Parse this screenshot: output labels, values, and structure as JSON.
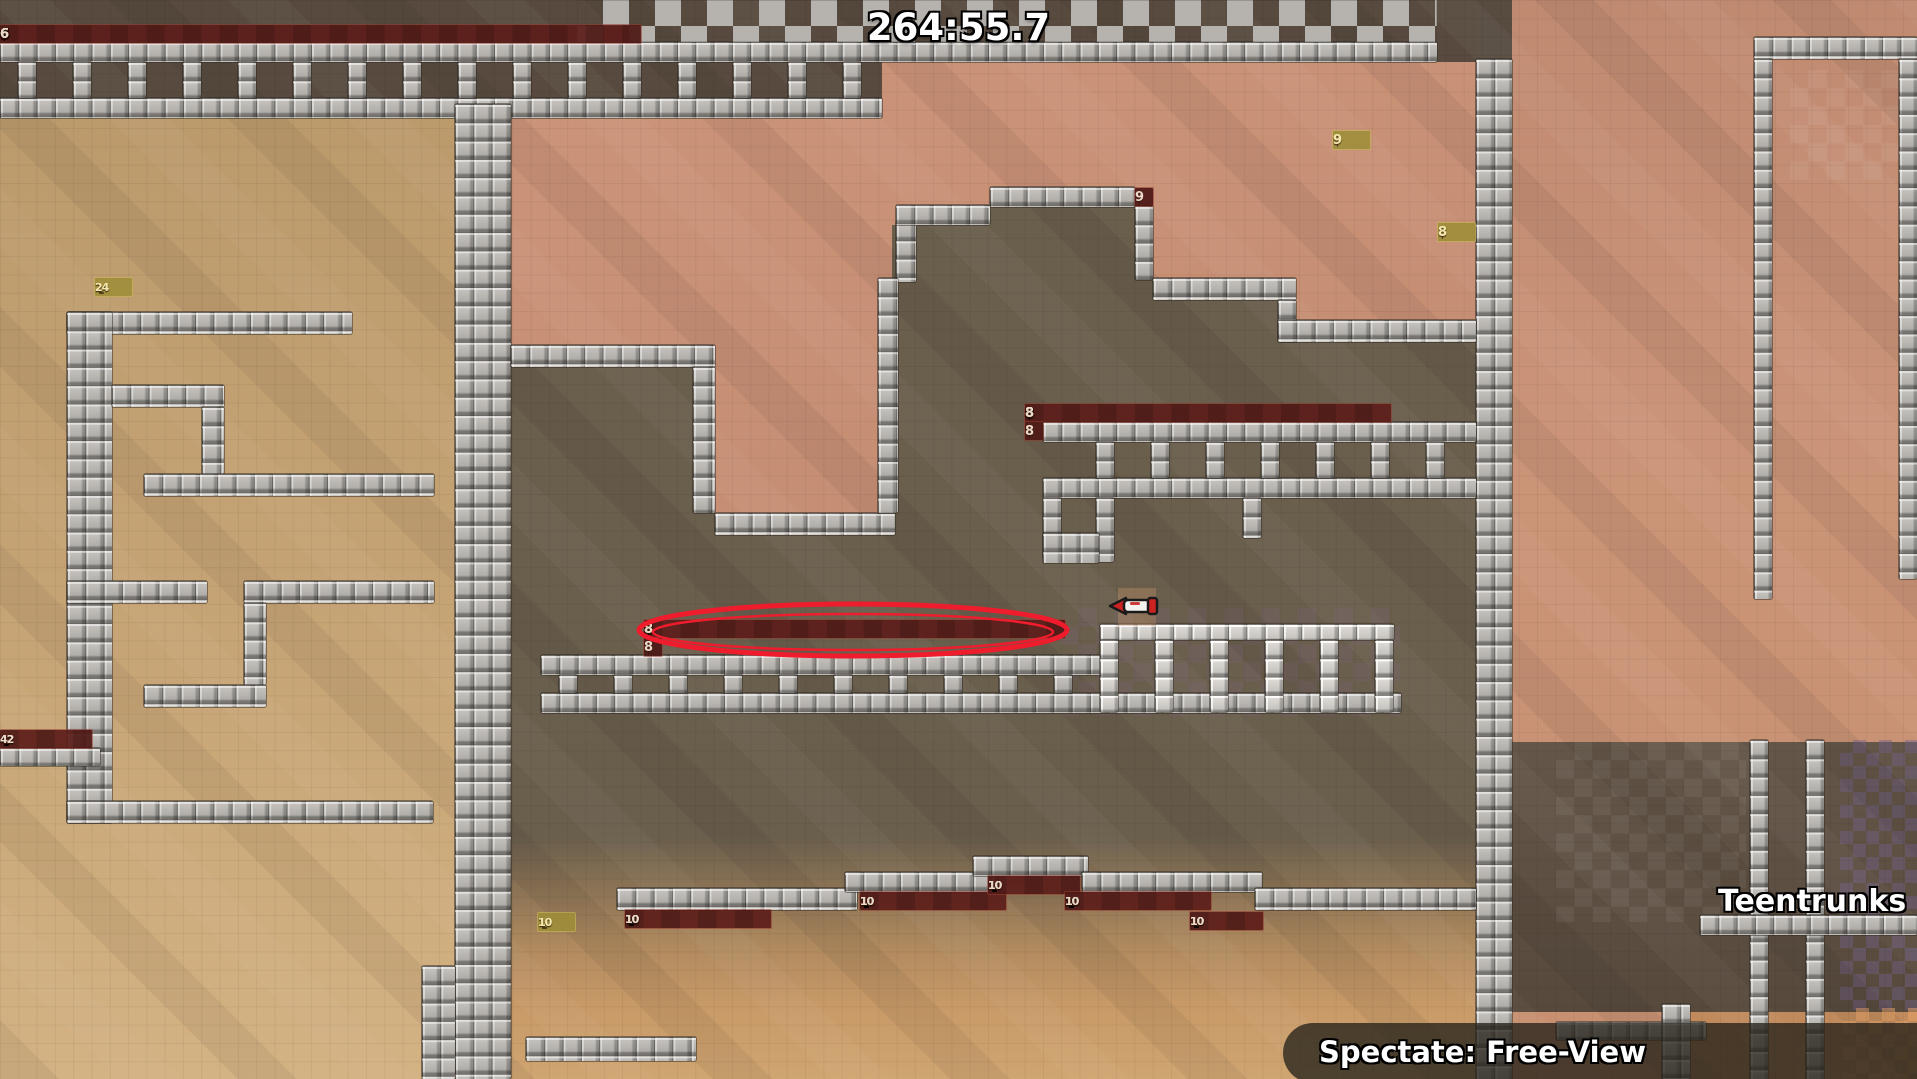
{
  "hud": {
    "timer": "264:55.7",
    "spectate_label": "Spectate: Free-View"
  },
  "scoreboard": {
    "entries": [
      {
        "rank": "1.",
        "name": "Teentrunks",
        "has_avatar": true
      },
      {
        "rank": "2.",
        "name": "",
        "has_avatar": false
      }
    ]
  },
  "colors": {
    "highlight_ellipse": "#ee1c2c",
    "freeze_strip_bg": "#5c1e1a",
    "freeze_strip_text": "#ead9c6",
    "switch_strip_bg": "#9e8e3a",
    "switch_strip_text": "#f4e7ac",
    "tile_face": "#b5b2ad",
    "hud_text": "#ffffff"
  },
  "map": {
    "tile_size": 18.3,
    "regions": [
      {
        "cls": "darktop",
        "x": 0,
        "y": 0,
        "w": 1476,
        "h": 62
      },
      {
        "cls": "left",
        "x": 0,
        "y": 116,
        "w": 455,
        "h": 963
      },
      {
        "cls": "peach",
        "x": 455,
        "y": 62,
        "w": 1021,
        "h": 680
      },
      {
        "cls": "ladderint",
        "x": 0,
        "y": 62,
        "w": 882,
        "h": 56
      },
      {
        "cls": "olive",
        "x": 511,
        "y": 187,
        "w": 965,
        "h": 555
      },
      {
        "cls": "bottom",
        "x": 455,
        "y": 742,
        "w": 1021,
        "h": 337
      },
      {
        "cls": "right",
        "x": 1512,
        "y": 0,
        "w": 405,
        "h": 1079
      },
      {
        "cls": "rightbottom",
        "x": 1512,
        "y": 742,
        "w": 405,
        "h": 270
      },
      {
        "cls": "rightbr",
        "x": 1690,
        "y": 1012,
        "w": 227,
        "h": 67
      }
    ],
    "walls": [
      [
        0,
        42,
        1437,
        20
      ],
      [
        0,
        98,
        882,
        20
      ],
      [
        1754,
        37,
        163,
        22
      ],
      [
        1754,
        59,
        18,
        540
      ],
      [
        1899,
        59,
        18,
        520
      ],
      [
        1476,
        59,
        36,
        1021
      ],
      [
        455,
        104,
        56,
        975
      ],
      [
        67,
        312,
        285,
        22
      ],
      [
        67,
        312,
        45,
        511
      ],
      [
        112,
        385,
        112,
        22
      ],
      [
        202,
        407,
        22,
        67
      ],
      [
        144,
        474,
        290,
        22
      ],
      [
        67,
        581,
        140,
        22
      ],
      [
        244,
        581,
        190,
        22
      ],
      [
        244,
        603,
        22,
        82
      ],
      [
        144,
        685,
        122,
        22
      ],
      [
        67,
        801,
        366,
        22
      ],
      [
        0,
        748,
        100,
        18
      ],
      [
        511,
        345,
        204,
        22
      ],
      [
        693,
        367,
        22,
        146
      ],
      [
        715,
        513,
        180,
        22
      ],
      [
        896,
        222,
        20,
        60
      ],
      [
        878,
        278,
        20,
        235
      ],
      [
        896,
        205,
        94,
        20
      ],
      [
        990,
        187,
        145,
        20
      ],
      [
        1135,
        206,
        18,
        74
      ],
      [
        1153,
        278,
        143,
        22
      ],
      [
        1278,
        300,
        18,
        42
      ],
      [
        1278,
        320,
        198,
        22
      ],
      [
        1043,
        422,
        433,
        20
      ],
      [
        1043,
        478,
        433,
        20
      ],
      [
        1043,
        498,
        18,
        60
      ],
      [
        1096,
        498,
        18,
        64
      ],
      [
        1043,
        533,
        56,
        30
      ],
      [
        1243,
        498,
        18,
        40
      ],
      [
        541,
        655,
        560,
        20
      ],
      [
        541,
        693,
        860,
        20
      ],
      [
        617,
        888,
        240,
        22
      ],
      [
        845,
        872,
        150,
        20
      ],
      [
        973,
        856,
        115,
        20
      ],
      [
        1082,
        872,
        180,
        20
      ],
      [
        1255,
        888,
        221,
        22
      ],
      [
        526,
        1037,
        170,
        24
      ],
      [
        422,
        966,
        33,
        113
      ],
      [
        1750,
        740,
        18,
        340
      ],
      [
        1806,
        740,
        18,
        340
      ],
      [
        1700,
        915,
        217,
        20
      ],
      [
        1556,
        1022,
        150,
        18
      ],
      [
        1662,
        1004,
        28,
        75
      ]
    ],
    "light_walls": [
      [
        1100,
        624,
        294,
        16
      ]
    ],
    "combs": [
      {
        "x": 18,
        "y": 62,
        "h": 36,
        "count": 16,
        "gap": 55,
        "light": false
      },
      {
        "x": 1096,
        "y": 442,
        "h": 36,
        "count": 7,
        "gap": 55,
        "light": false
      },
      {
        "x": 559,
        "y": 675,
        "h": 18,
        "count": 10,
        "gap": 55,
        "light": false
      },
      {
        "x": 1100,
        "y": 640,
        "h": 72,
        "count": 6,
        "gap": 55,
        "light": true
      }
    ],
    "checkers": [
      {
        "cls": "tiles",
        "x": 577,
        "y": 0,
        "w": 860,
        "h": 42
      },
      {
        "cls": "purple",
        "x": 1840,
        "y": 740,
        "w": 77,
        "h": 270
      },
      {
        "cls": "orange",
        "x": 1843,
        "y": 1008,
        "w": 74,
        "h": 71
      },
      {
        "cls": "purplefaint",
        "x": 1060,
        "y": 608,
        "w": 340,
        "h": 108
      },
      {
        "cls": "ghost",
        "x": 1556,
        "y": 742,
        "w": 190,
        "h": 180
      },
      {
        "cls": "ghost",
        "x": 1790,
        "y": 70,
        "w": 127,
        "h": 110
      }
    ],
    "strips": [
      {
        "num": "6",
        "type": "red",
        "x": 0,
        "y": 25,
        "count": 35
      },
      {
        "num": "24",
        "type": "yellow",
        "x": 95,
        "y": 278,
        "count": 2
      },
      {
        "num": "9",
        "type": "yellow",
        "x": 1333,
        "y": 131,
        "count": 2
      },
      {
        "num": "9",
        "type": "red",
        "x": 1135,
        "y": 188,
        "count": 1
      },
      {
        "num": "8",
        "type": "yellow",
        "x": 1438,
        "y": 223,
        "count": 2
      },
      {
        "num": "8",
        "type": "red",
        "x": 1025,
        "y": 404,
        "count": 20
      },
      {
        "num": "8",
        "type": "red",
        "x": 1025,
        "y": 422,
        "count": 1
      },
      {
        "num": "8",
        "type": "red",
        "x": 644,
        "y": 620,
        "count": 23
      },
      {
        "num": "8",
        "type": "red",
        "x": 644,
        "y": 638,
        "count": 1
      },
      {
        "num": "42",
        "type": "red",
        "x": 0,
        "y": 730,
        "count": 5
      },
      {
        "num": "10",
        "type": "yellow",
        "x": 538,
        "y": 913,
        "count": 2
      },
      {
        "num": "10",
        "type": "red",
        "x": 625,
        "y": 910,
        "count": 8
      },
      {
        "num": "10",
        "type": "red",
        "x": 860,
        "y": 892,
        "count": 8
      },
      {
        "num": "10",
        "type": "red",
        "x": 988,
        "y": 876,
        "count": 5
      },
      {
        "num": "10",
        "type": "red",
        "x": 1065,
        "y": 892,
        "count": 8
      },
      {
        "num": "10",
        "type": "red",
        "x": 1190,
        "y": 912,
        "count": 4
      }
    ],
    "annotations": {
      "ellipse": {
        "x": 630,
        "y": 598,
        "w": 446,
        "h": 64
      },
      "pickup": {
        "x": 1104,
        "y": 584,
        "w": 62,
        "h": 46
      }
    }
  }
}
